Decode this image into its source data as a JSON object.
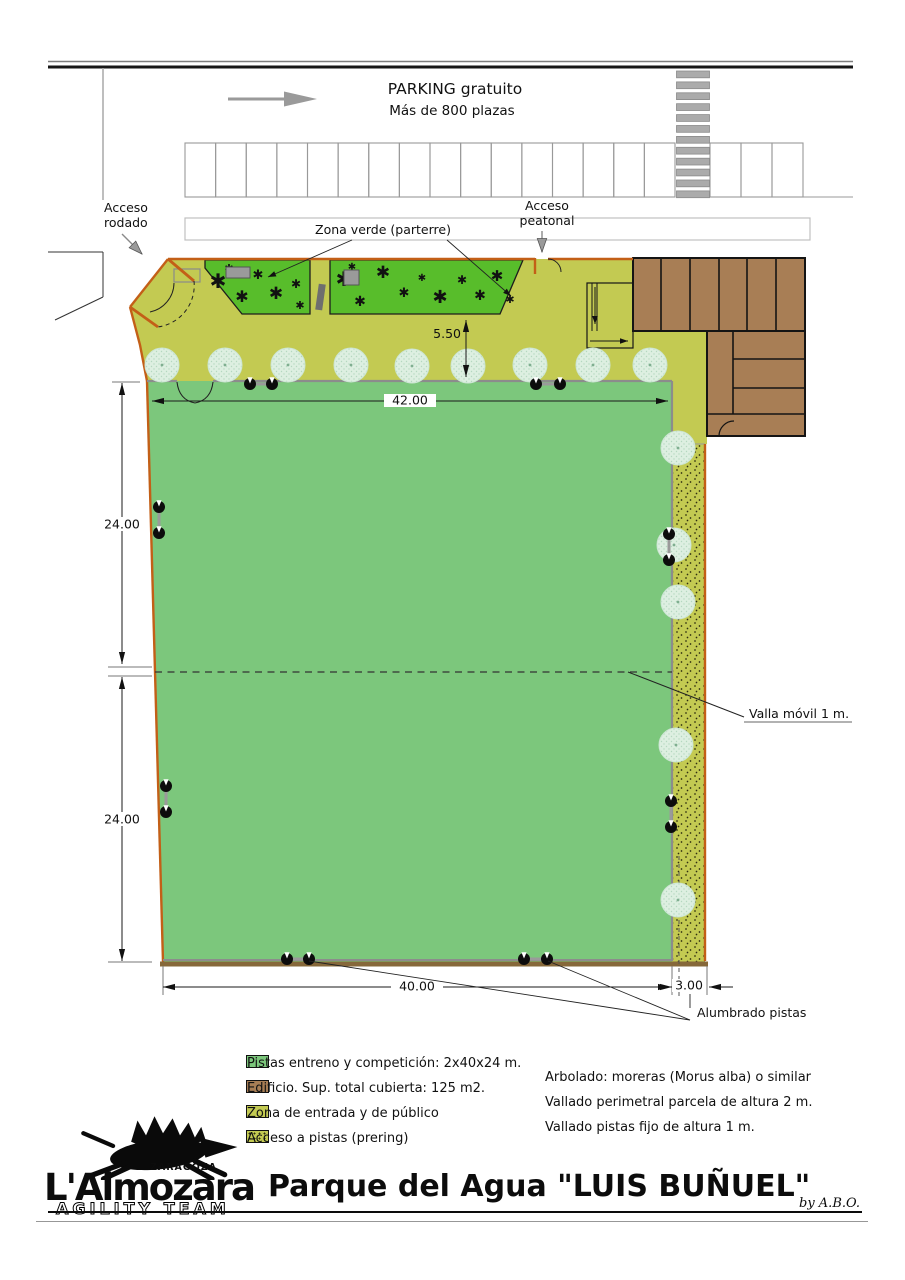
{
  "street": {
    "parking_title": "PARKING gratuito",
    "parking_subtitle": "Más de 800 plazas"
  },
  "labels": {
    "acceso_rodado_1": "Acceso",
    "acceso_rodado_2": "rodado",
    "zona_verde": "Zona verde (parterre)",
    "acceso_peatonal_1": "Acceso",
    "acceso_peatonal_2": "peatonal",
    "valla_movil": "Valla móvil 1 m.",
    "alumbrado": "Alumbrado pistas"
  },
  "dimensions": {
    "top_offset": "5.50",
    "pista_width": "42.00",
    "pista_height_upper": "24.00",
    "pista_height_lower": "24.00",
    "pista_bottom": "40.00",
    "prering_width": "3.00"
  },
  "legend_left": [
    {
      "key": "pista",
      "label": "Pistas entreno y competición: 2x40x24 m."
    },
    {
      "key": "building",
      "label": "Edificio. Sup. total cubierta: 125 m2."
    },
    {
      "key": "olive",
      "label": "Zona de entrada y de público"
    },
    {
      "key": "prering",
      "label": "Acceso a pistas (prering)"
    }
  ],
  "legend_right": [
    {
      "key": "tree",
      "label": "Arbolado: moreras (Morus alba) o similar"
    },
    {
      "key": "fence2m",
      "label": "Vallado perimetral parcela de altura 2 m."
    },
    {
      "key": "fence1m",
      "label": "Vallado pistas fijo de altura 1 m."
    }
  ],
  "title_block": {
    "team": "L'Almozara",
    "city": "ZARAGOZA",
    "team_sub": "AGILITY TEAM",
    "title": "Parque del Agua \"LUIS BUÑUEL\"",
    "byline": "by A.B.O."
  },
  "colors": {
    "pista": "#7cc77c",
    "parterre": "#58bd2b",
    "entrance_zone": "#c3ca52",
    "building": "#a87e55",
    "perimeter_fence": "#c35f17",
    "pista_fence": "#8c8c8c",
    "tree": "#def0e2"
  },
  "map": {
    "parking": {
      "left_stalls": 16,
      "right_stalls": 3,
      "crosswalk_stripes": 12
    },
    "trees": [
      [
        162,
        365
      ],
      [
        225,
        365
      ],
      [
        288,
        365
      ],
      [
        351,
        365
      ],
      [
        412,
        366
      ],
      [
        468,
        366
      ],
      [
        530,
        365
      ],
      [
        593,
        365
      ],
      [
        650,
        365
      ],
      [
        678,
        448
      ],
      [
        674,
        545
      ],
      [
        678,
        602
      ],
      [
        676,
        745
      ],
      [
        678,
        900
      ]
    ],
    "plants": [
      [
        218,
        288,
        20
      ],
      [
        242,
        302,
        16
      ],
      [
        258,
        279,
        13
      ],
      [
        276,
        299,
        17
      ],
      [
        296,
        288,
        12
      ],
      [
        229,
        272,
        11
      ],
      [
        300,
        309,
        11
      ],
      [
        344,
        286,
        20
      ],
      [
        360,
        306,
        14
      ],
      [
        383,
        278,
        17
      ],
      [
        404,
        297,
        13
      ],
      [
        422,
        281,
        10
      ],
      [
        440,
        303,
        18
      ],
      [
        462,
        284,
        12
      ],
      [
        480,
        300,
        14
      ],
      [
        497,
        281,
        15
      ],
      [
        510,
        303,
        11
      ],
      [
        352,
        270,
        10
      ]
    ],
    "lights": [
      {
        "x1": 250,
        "y1": 384,
        "x2": 272,
        "y2": 384
      },
      {
        "x1": 536,
        "y1": 384,
        "x2": 560,
        "y2": 384
      },
      {
        "x1": 159,
        "y1": 507,
        "x2": 159,
        "y2": 533
      },
      {
        "x1": 166,
        "y1": 786,
        "x2": 166,
        "y2": 812
      },
      {
        "x1": 669,
        "y1": 534,
        "x2": 669,
        "y2": 560
      },
      {
        "x1": 671,
        "y1": 801,
        "x2": 671,
        "y2": 827
      },
      {
        "x1": 287,
        "y1": 959,
        "x2": 309,
        "y2": 959
      },
      {
        "x1": 524,
        "y1": 959,
        "x2": 547,
        "y2": 959
      }
    ]
  }
}
